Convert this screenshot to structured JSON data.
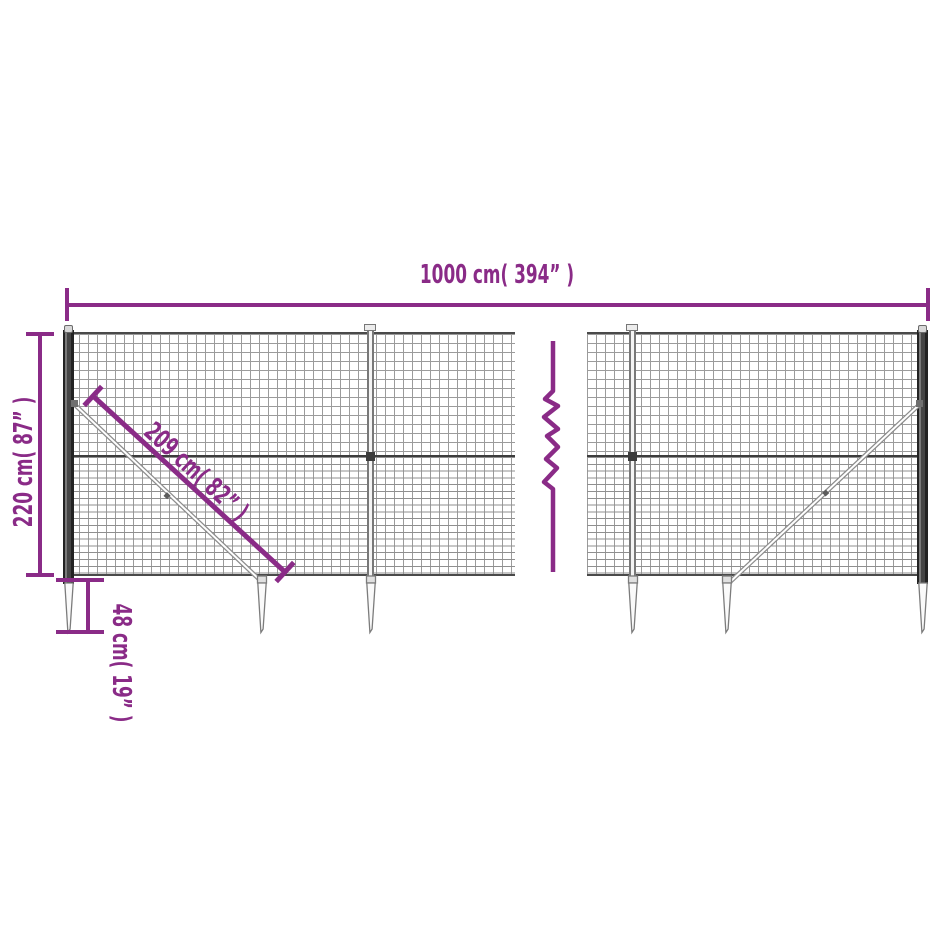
{
  "diagram": {
    "title": "wire-mesh-fence-dimension-diagram",
    "labels": {
      "total_width": "1000 cm( 394” )",
      "total_height": "220 cm( 87” )",
      "brace_length": "209 cm( 82” )",
      "spike_depth": "48 cm( 19” )"
    },
    "colors": {
      "dimension_accent": "#8a2b87",
      "mesh_line": "#9a9a9a",
      "mesh_rail_dark": "#3c3c3c",
      "post_dark": "#3a3a3a",
      "spike_outline": "#7c7c7c",
      "background": "#ffffff"
    }
  }
}
